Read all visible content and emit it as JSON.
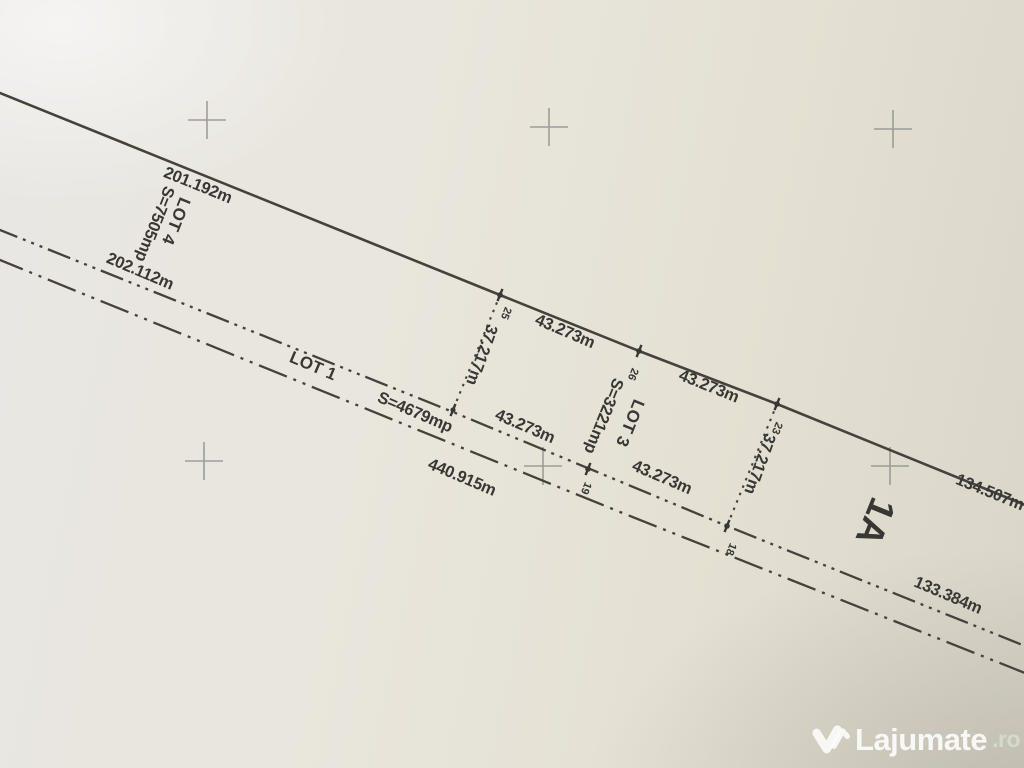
{
  "plan": {
    "boundary_top": {
      "left_segment": "201.192m",
      "seg_25_26": "43.273m",
      "seg_26_23": "43.273m",
      "right_segment": "134.507m"
    },
    "lot4": {
      "label": "LOT 4",
      "area": "S=7505mp",
      "bottom": "202.112m"
    },
    "lot3": {
      "label": "LOT 3",
      "area": "S=3221mp",
      "side_left": "37.217m",
      "side_right": "37.217m",
      "bottom_seg1": "43.273m",
      "bottom_seg2": "43.273m"
    },
    "lot1": {
      "label": "LOT 1",
      "area": "S=4679mp",
      "lower_total": "440.915m",
      "right_segment": "133.384m"
    },
    "remainder_mark": "1A",
    "points": {
      "p25": "25",
      "p26": "26",
      "p23": "23",
      "p19": "19",
      "p18": "18"
    },
    "colors": {
      "ink": "#3a3733",
      "paper": "#e7e4db",
      "cross": "#8b8b86"
    }
  },
  "watermark": {
    "brand": "Lajumate",
    "tld": ".ro",
    "icon": "heart-check-logo"
  }
}
